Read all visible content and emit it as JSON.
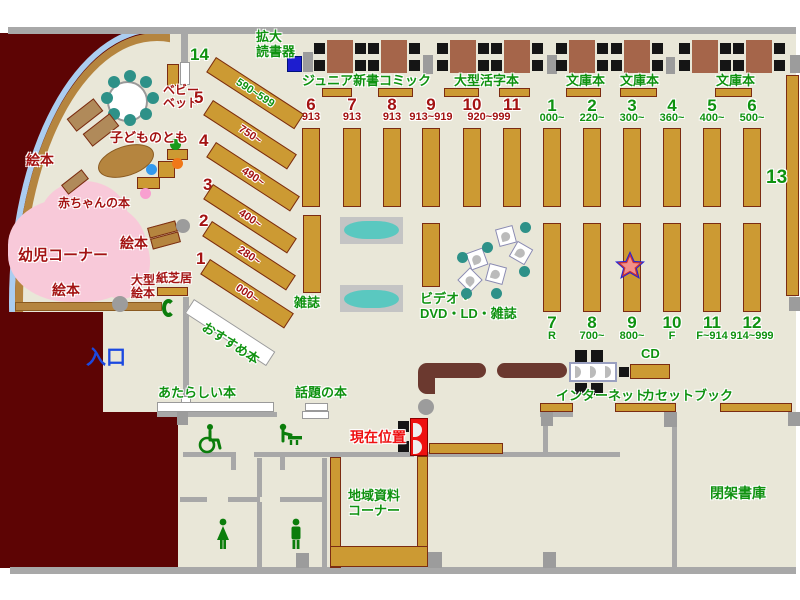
{
  "palette": {
    "floor": "#e9e7d8",
    "wall_gray": "#a8a8a8",
    "wall_dark_red": "#5d0404",
    "shelf": "#cc9a33",
    "shelf_border": "#7b2c12",
    "table_brown": "#a5654a",
    "chair_black": "#151515",
    "teal_chair": "#2e9188",
    "magazine_teal": "#5ac8c0",
    "kids_pink": "#f8c9d9",
    "rim_light_blue": "#abcdf0",
    "label_green": "#0f9210",
    "label_dark_red": "#a31212",
    "current_red": "#ee1111",
    "entrance_blue": "#1b49e0",
    "counter_brown": "#6b392f",
    "reader_blue": "#1d1dcf"
  },
  "kids": {
    "baby_bed": "ベビー\nベッド",
    "kodomo_no_tomo": "子どものとも",
    "ehon_left": "絵本",
    "akachan_books": "赤ちゃんの本",
    "yoji_corner": "幼児コーナー",
    "ehon_mid": "絵本",
    "ehon_bottom": "絵本",
    "ogata_ehon": "大型\n絵本",
    "kamishibai": "紙芝居",
    "osusume": "おすすめ本"
  },
  "top_area": {
    "kakudai_dokushoki": "拡大\n読書器",
    "junior_shinsho": "ジュニア新書",
    "comic": "コミック",
    "ogata_katsuji": "大型活字本",
    "bunko_a": "文庫本",
    "bunko_b": "文庫本",
    "bunko_c": "文庫本"
  },
  "diag_shelves": [
    {
      "no": "14",
      "range": "590~599"
    },
    {
      "no": "5",
      "range": "750~"
    },
    {
      "no": "4",
      "range": "490~"
    },
    {
      "no": "3",
      "range": "400~"
    },
    {
      "no": "2",
      "range": "280~"
    },
    {
      "no": "1",
      "range": "000~"
    }
  ],
  "mid_red": {
    "nos": [
      "6",
      "7",
      "8",
      "9",
      "10",
      "11"
    ],
    "ranges": [
      "913",
      "913",
      "913",
      "913~919",
      "920~999"
    ]
  },
  "top_green": [
    {
      "no": "1",
      "range": "000~"
    },
    {
      "no": "2",
      "range": "220~"
    },
    {
      "no": "3",
      "range": "300~"
    },
    {
      "no": "4",
      "range": "360~"
    },
    {
      "no": "5",
      "range": "400~"
    },
    {
      "no": "6",
      "range": "500~"
    }
  ],
  "bottom_green": [
    {
      "no": "7",
      "range": "R"
    },
    {
      "no": "8",
      "range": "700~"
    },
    {
      "no": "9",
      "range": "800~"
    },
    {
      "no": "10",
      "range": "F"
    },
    {
      "no": "11",
      "range": "F~914"
    },
    {
      "no": "12",
      "range": "914~999"
    }
  ],
  "shelf_13": "13",
  "center_area": {
    "zasshi": "雑誌",
    "video": "ビデオ・\nDVD・LD・雑誌"
  },
  "south": {
    "atarashii": "あたらしい本",
    "wadai": "話題の本",
    "internet": "インターネット",
    "cd": "CD",
    "cassette": "カセットブック",
    "chiiki": "地域資料\nコーナー",
    "heika": "閉架書庫"
  },
  "markers": {
    "genzai": "現在位置",
    "iriguchi": "入口"
  }
}
